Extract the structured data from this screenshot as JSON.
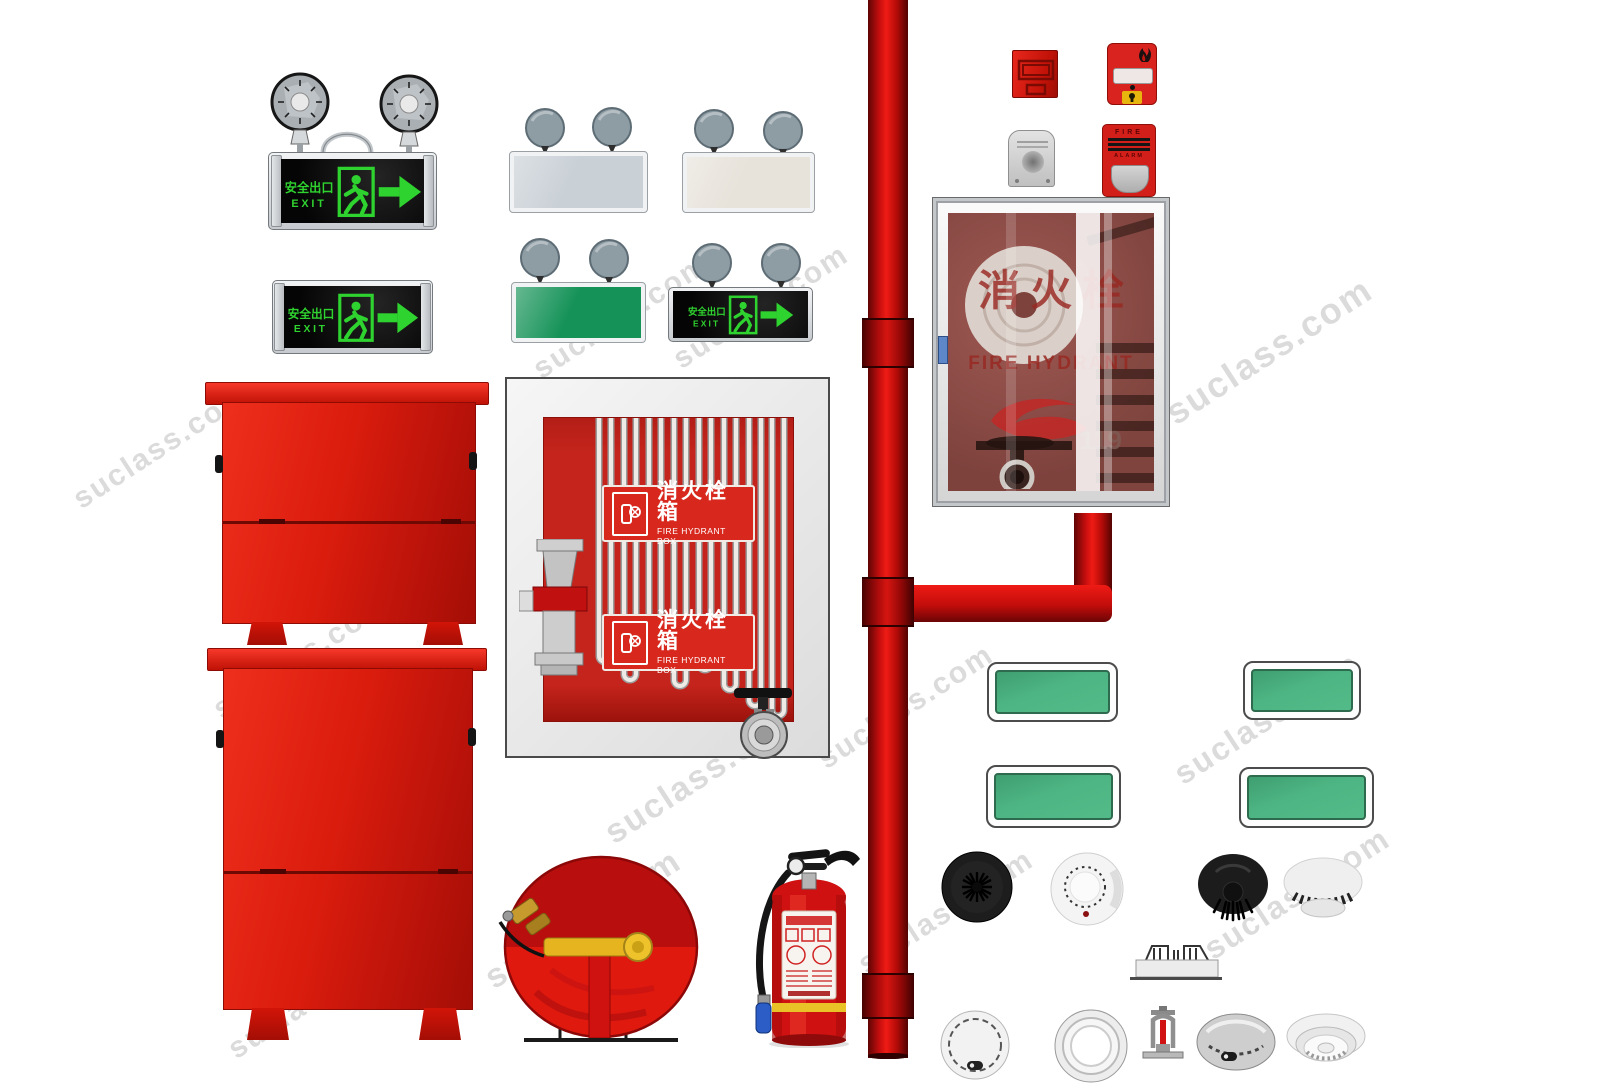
{
  "watermark": {
    "text": "suclass.com"
  },
  "signs": {
    "exit_cn": "安全出口",
    "exit_en": "EXIT"
  },
  "hydrant_box": {
    "label_cn": "消火栓箱",
    "label_en": "FIRE HYDRANT BOX"
  },
  "hydrant_cabinet": {
    "label_cn": "消火栓",
    "label_en": "FIRE HYDRANT",
    "phone": "119"
  },
  "alarm": {
    "line1": "FIRE",
    "line2": "ALARM"
  },
  "colors": {
    "fire_red": "#d01414",
    "dark_red": "#8f0b0b",
    "sign_green": "#2fd32f",
    "panel_green": "#4db583",
    "lamp_gray": "#8e9ca4",
    "frame_silver": "#d7dadd"
  },
  "items": [
    "twin-spotlight-exit-light",
    "exit-sign",
    "twin-lamp-panel-gray",
    "twin-lamp-panel-ivory",
    "twin-lamp-panel-green",
    "twin-lamp-exit-sign",
    "manual-call-point",
    "fire-alarm-pull-station",
    "call-point-protective-cover",
    "fire-alarm-strobe",
    "fire-hydrant-glass-cabinet",
    "red-fire-cabinet-small",
    "red-fire-cabinet-tall",
    "fire-hydrant-box",
    "fire-riser-pipe",
    "green-blank-sign",
    "smoke-detector-black",
    "smoke-detector-white",
    "pendant-sprinkler-black",
    "smoke-detector-side-view",
    "fire-hose-reel",
    "fire-extinguisher",
    "concealed-sprinkler-plate",
    "smoke-detector-round",
    "smoke-detector-rings",
    "upright-sprinkler",
    "smoke-detector-dome-gray",
    "smoke-detector-tiered"
  ]
}
